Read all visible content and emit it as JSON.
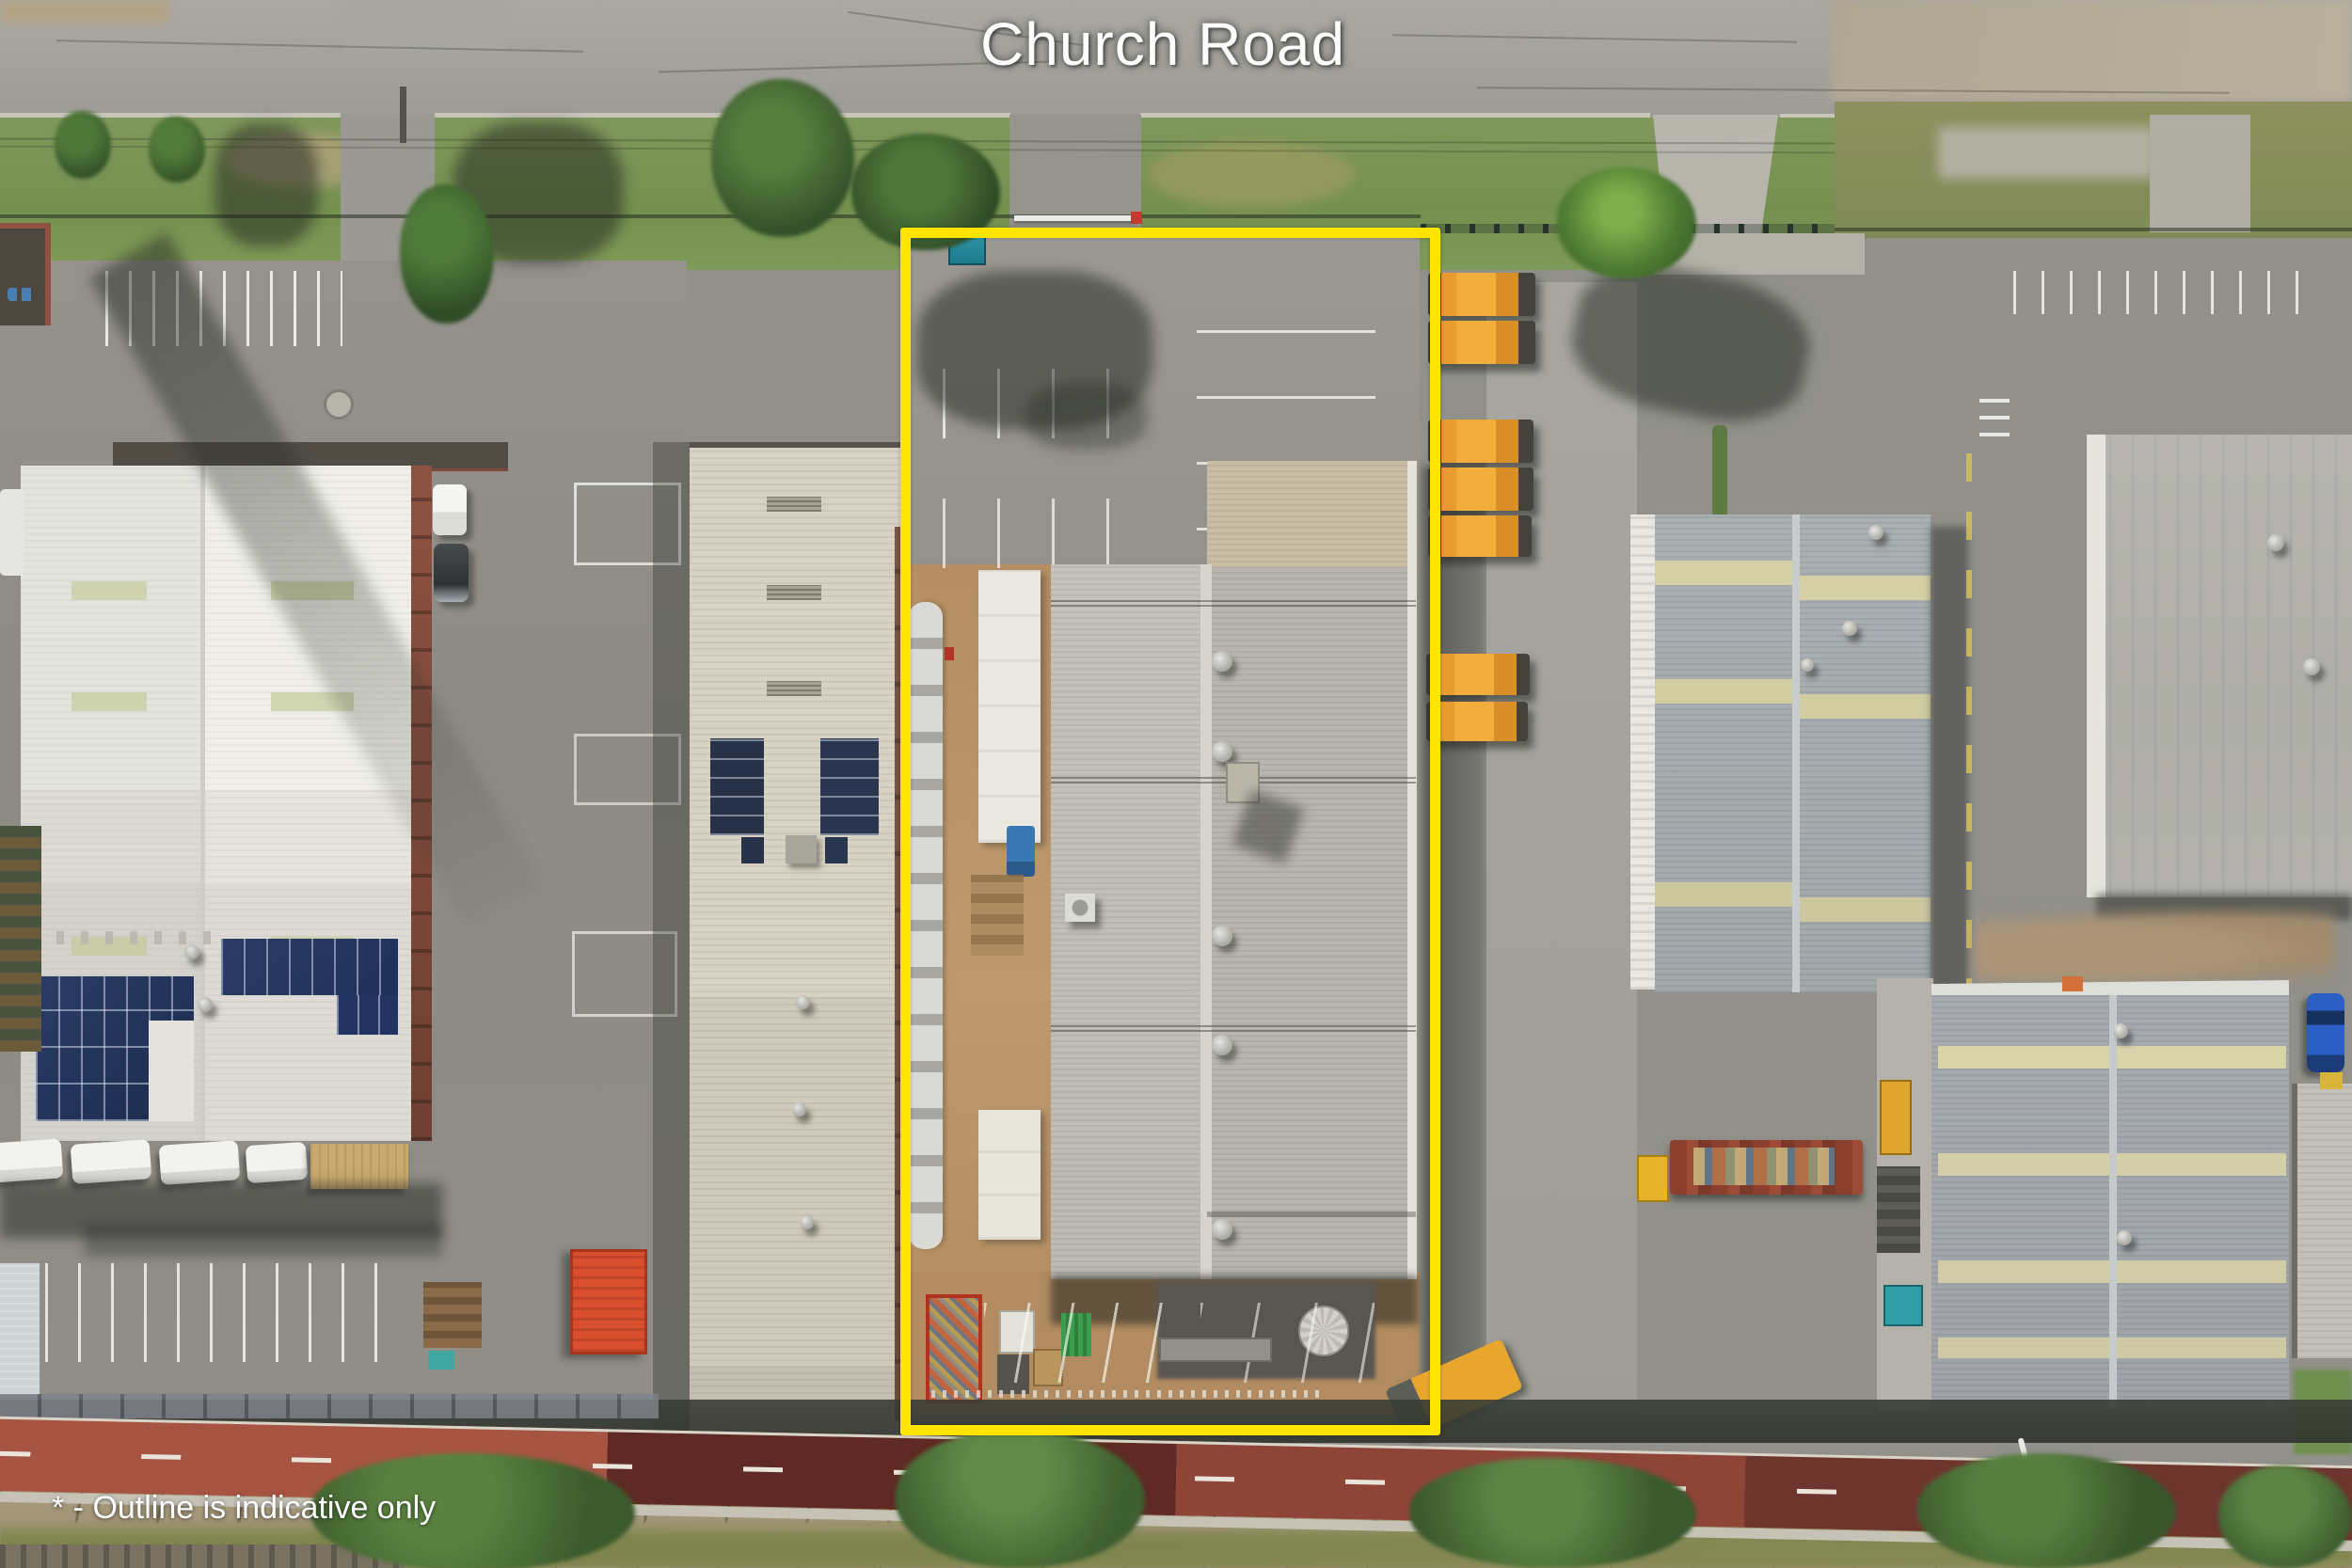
{
  "labels": {
    "road_name": "Church Road",
    "disclaimer": "* - Outline is indicative only"
  },
  "outline": {
    "color": "#FFE400",
    "meaning": "indicative property boundary",
    "marker": "*"
  },
  "scene": {
    "type": "aerial-drone-photo",
    "description": "Industrial properties along Church Road; subject lot outlined in yellow containing a large warehouse, front parking and rear yard; neighbouring warehouses, solar panel roofs, parked wheel loaders, palm tree, red bike path and rail corridor at bottom"
  }
}
